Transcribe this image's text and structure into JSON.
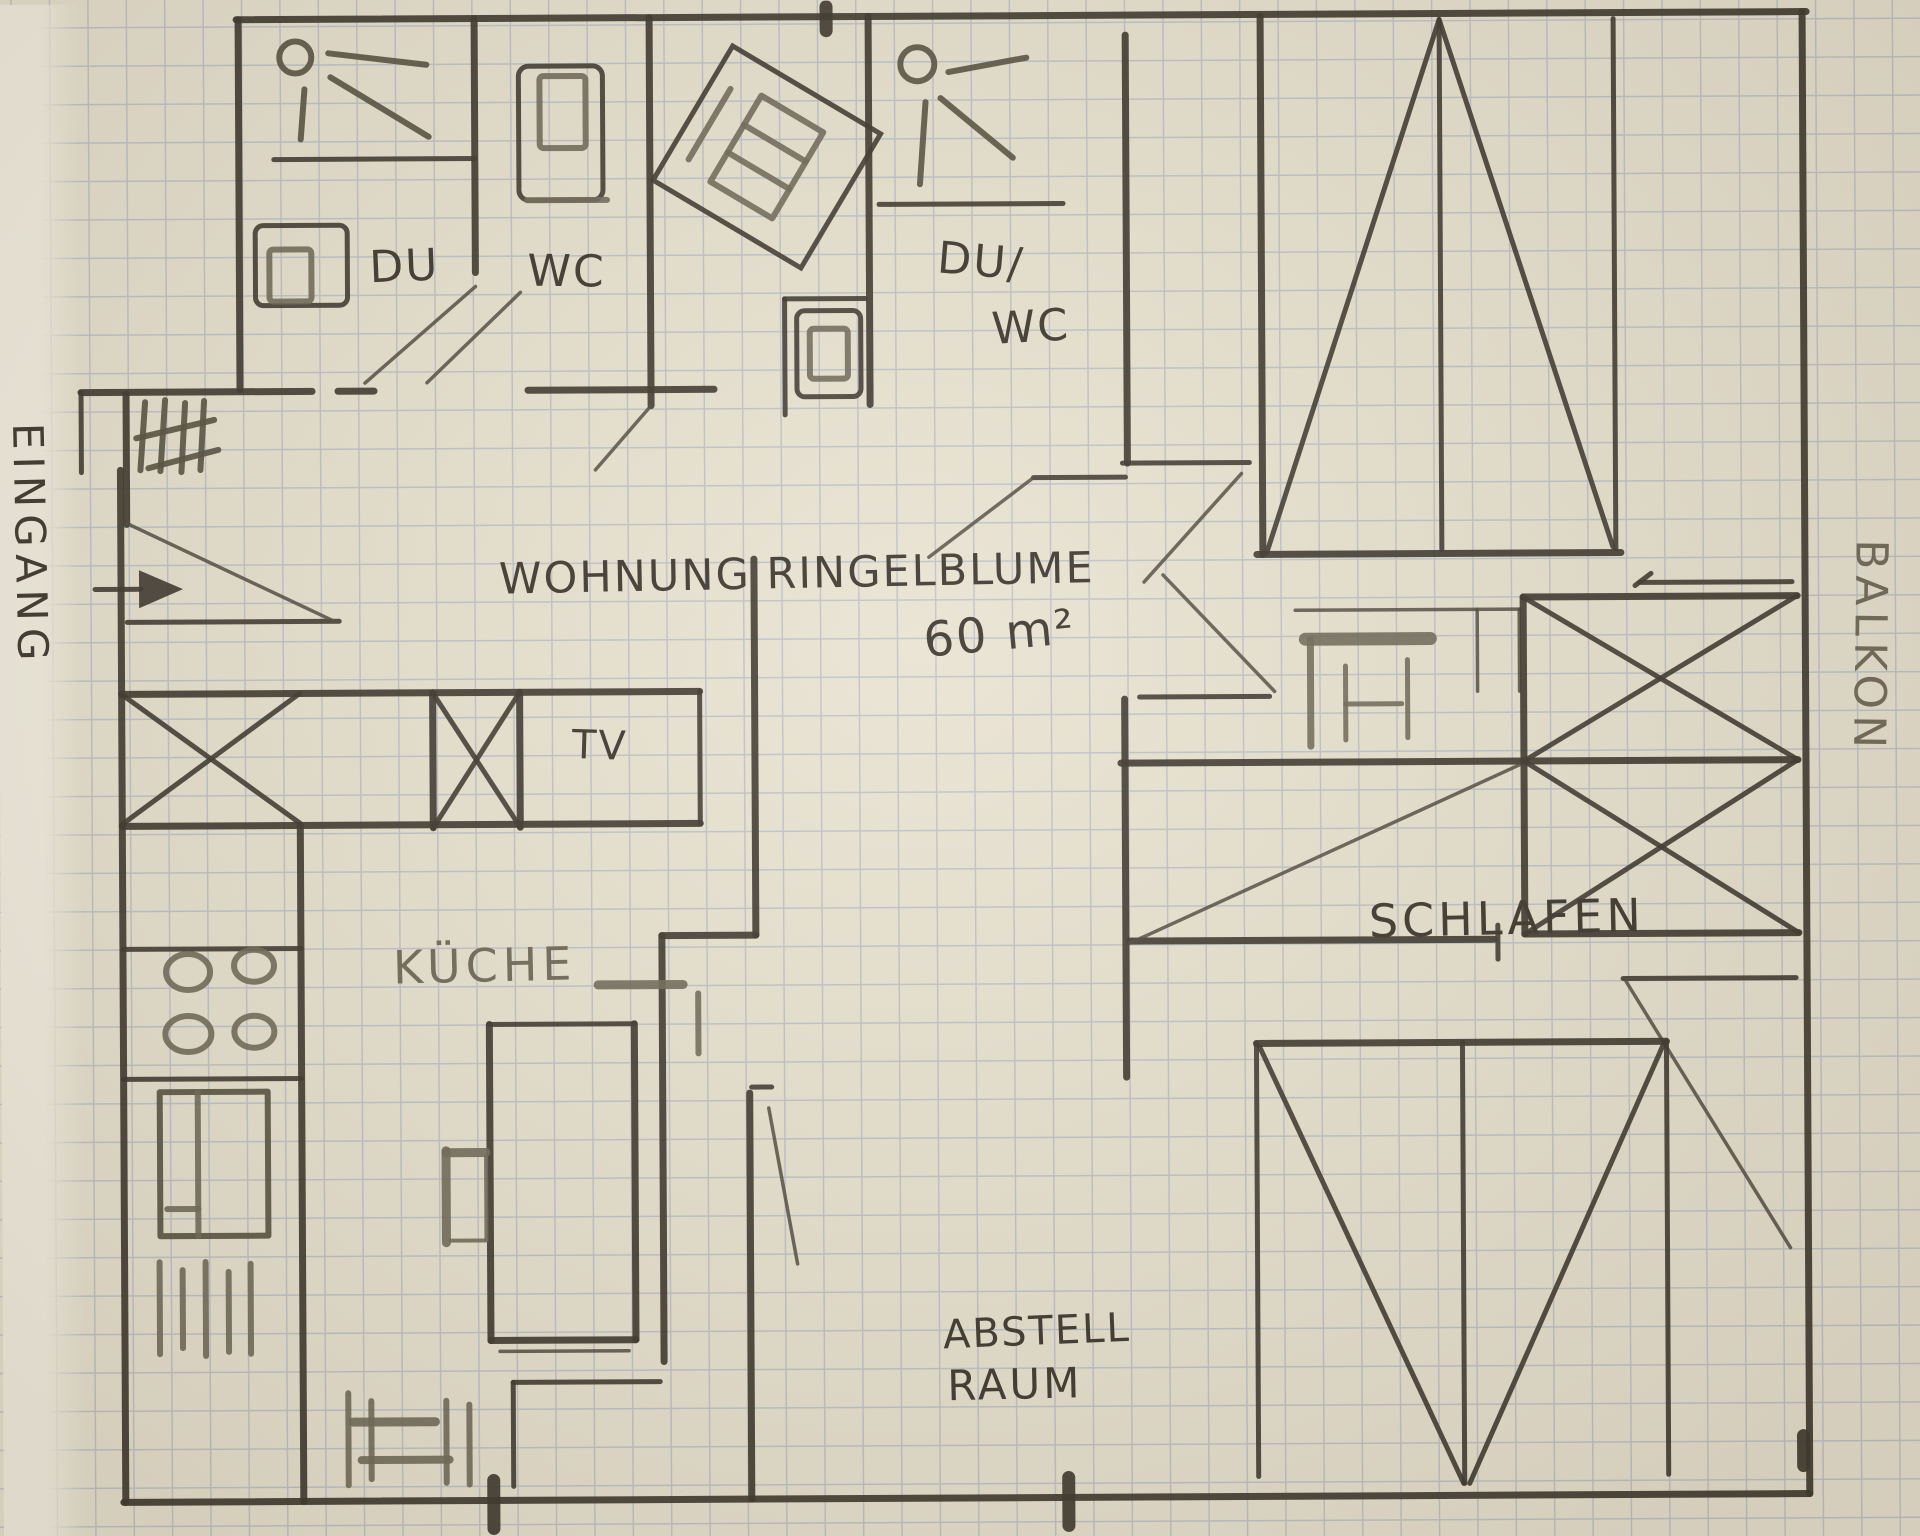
{
  "colors": {
    "paper": "#e8e2d0",
    "paper-edge": "#f3efe2",
    "grid": "#9aa4c2",
    "pencil": "#3a342b",
    "pencil-soft": "#6e6757",
    "pencil-mid": "#55503f",
    "swing": "#4c463c"
  },
  "labels": {
    "title": "WOHNUNG RINGELBLUME",
    "area": "60 m²",
    "eingang": "EINGANG",
    "balkon": "BALKON",
    "du": "DU",
    "wc": "WC",
    "du_wc_line1": "DU/",
    "du_wc_line2": "WC",
    "tv": "TV",
    "kueche": "KÜCHE",
    "schlafen": "SCHLAFEN",
    "abstell_line1": "ABSTELL",
    "abstell_line2": "RAUM"
  },
  "icons": {
    "entry-arrow-icon": "solid right-pointing arrow",
    "entry-stairs-hatch-icon": "tally strokes with slashes",
    "shower-icon": "circle head with spray lines",
    "toilet-icon": "rectangle with inner cistern rectangle",
    "washing-machine-icon": "tilted rectangle with drum lines",
    "fridge-icon": "x-crossed rectangle",
    "tv-board-icon": "x-crossed rectangle",
    "stove-icon": "four burner circles",
    "sink-icon": "rectangle with divider line",
    "kitchen-hatch-icon": "pencil tally strokes",
    "table-icon": "tall rectangle",
    "chair-icon": "small open rectangle",
    "bench-icon": "rails with posts",
    "desk-icon": "thick-edged square with inner lines",
    "wardrobe-triangle-icon": "triangle with center line in rectangle",
    "bed-icon": "double x-crossed rectangle",
    "door-swing-icon": "diagonal pencil stroke"
  }
}
